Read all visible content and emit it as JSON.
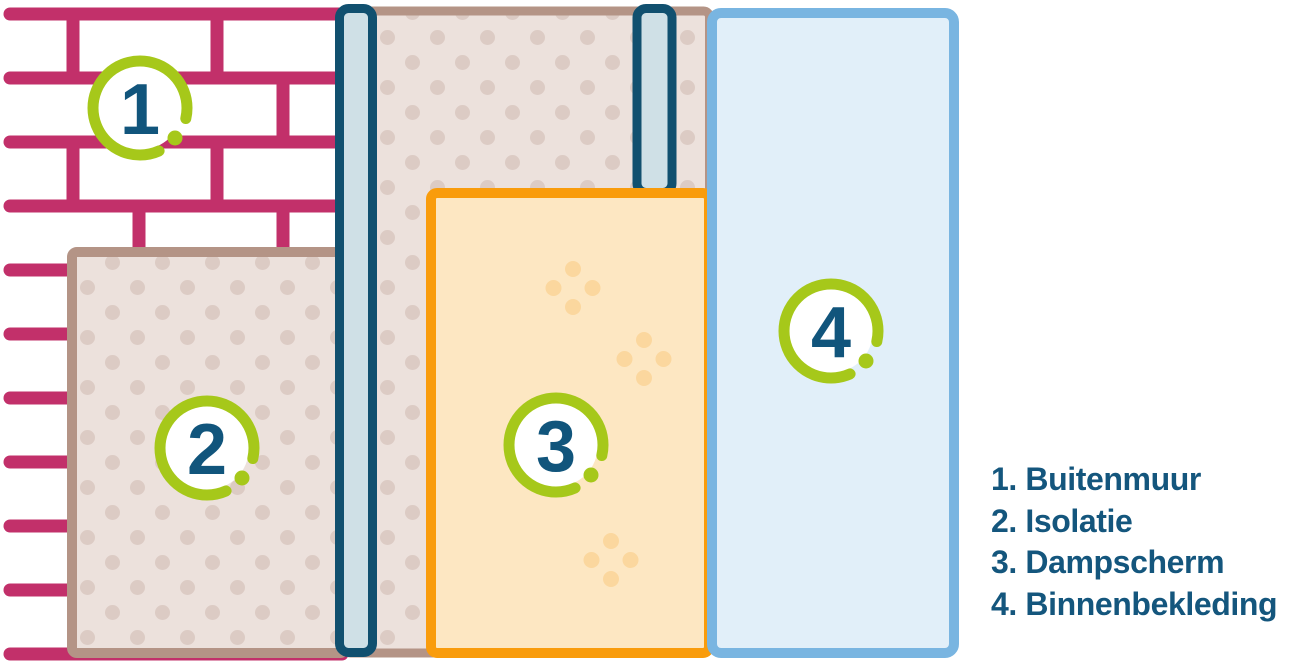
{
  "diagram": {
    "description": "Wall construction layers cutaway diagram",
    "badges": [
      "1",
      "2",
      "3",
      "4"
    ]
  },
  "legend": {
    "items": [
      "1. Buitenmuur",
      "2. Isolatie",
      "3. Dampscherm",
      "4. Binnenbekleding"
    ]
  },
  "texture": {
    "vapor_dot_clusters": [
      {
        "x": 573,
        "y": 288
      },
      {
        "x": 644,
        "y": 359
      },
      {
        "x": 611,
        "y": 560
      }
    ]
  },
  "colors": {
    "brick_mortar": "#c2306a",
    "panel_border_tan": "#b49486",
    "insulation_fill": "#ece1dc",
    "insulation_dot": "#dccbc4",
    "stud_border": "#11506f",
    "stud_fill": "#cfe0e6",
    "vapor_border": "#f99c0c",
    "vapor_fill": "#fde7c2",
    "vapor_dot": "#fbd79e",
    "cladding_border": "#79b5e1",
    "cladding_fill": "#e1eff9",
    "badge_ring_green": "#a6c81a",
    "badge_number_blue": "#11557c",
    "legend_text": "#14567d"
  }
}
